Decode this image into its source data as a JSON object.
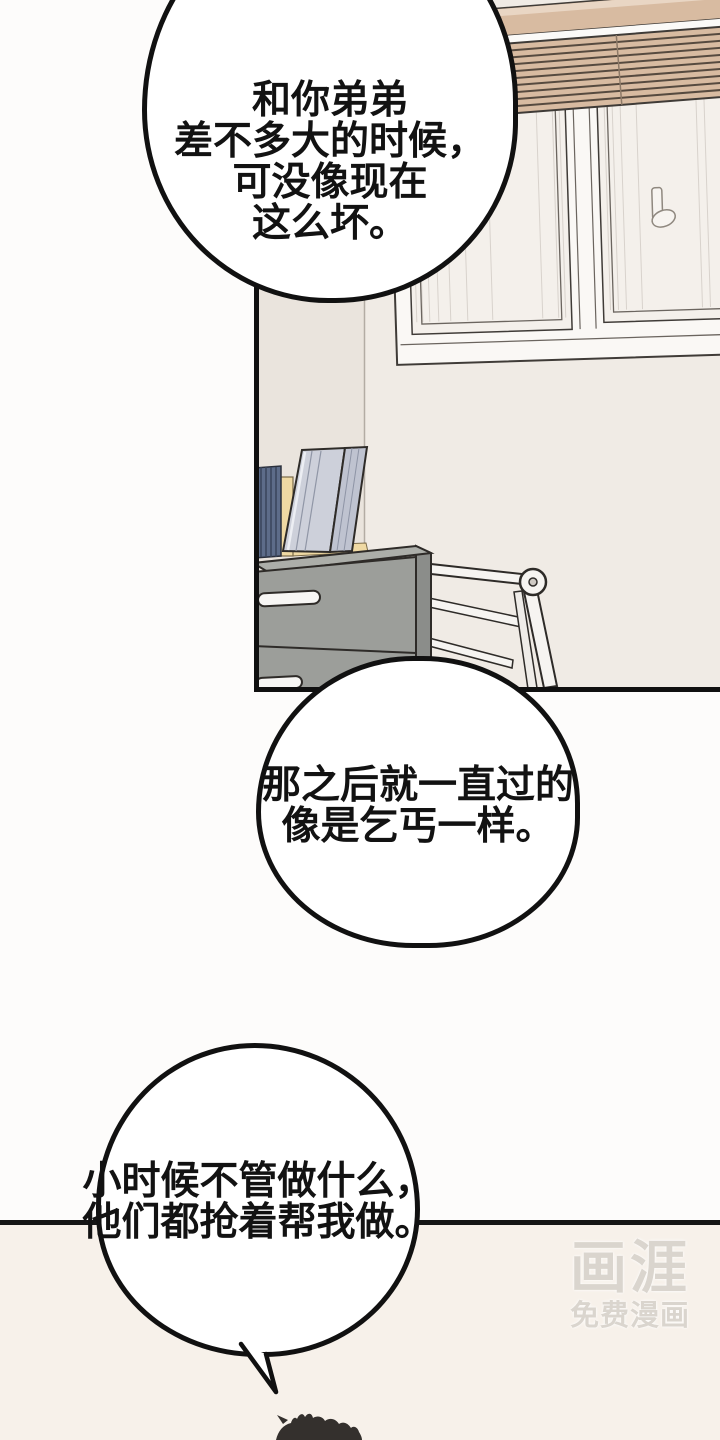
{
  "comic": {
    "bubbles": [
      {
        "lines": [
          "和你弟弟",
          "差不多大的时候，",
          "可没像现在",
          "这么坏。"
        ]
      },
      {
        "lines": [
          "那之后就一直过的",
          "像是乞丐一样。"
        ]
      },
      {
        "lines": [
          "小时候不管做什么，",
          "他们都抢着帮我做。"
        ]
      }
    ],
    "watermark": {
      "title": "画涯",
      "subtitle": "免费漫画"
    }
  },
  "colors": {
    "page_top_bg": "#FDFCFB",
    "page_bottom_bg": "#F7F1EA",
    "wall_left": "#EAE4DD",
    "wall_right": "#F0EBE5",
    "blinds_tan": "#D8BBA1",
    "window_frame": "#FAF8F5",
    "glass": "#F4F0EB",
    "dresser_gray": "#9C9E9A",
    "books_blue": "#5D6C89",
    "bookend_cream": "#EFD9A3",
    "binder_gray": "#CDD0DA",
    "outline_black": "#111111",
    "hair_dark": "#34302D",
    "watermark_gray": "#DAD5CE"
  }
}
